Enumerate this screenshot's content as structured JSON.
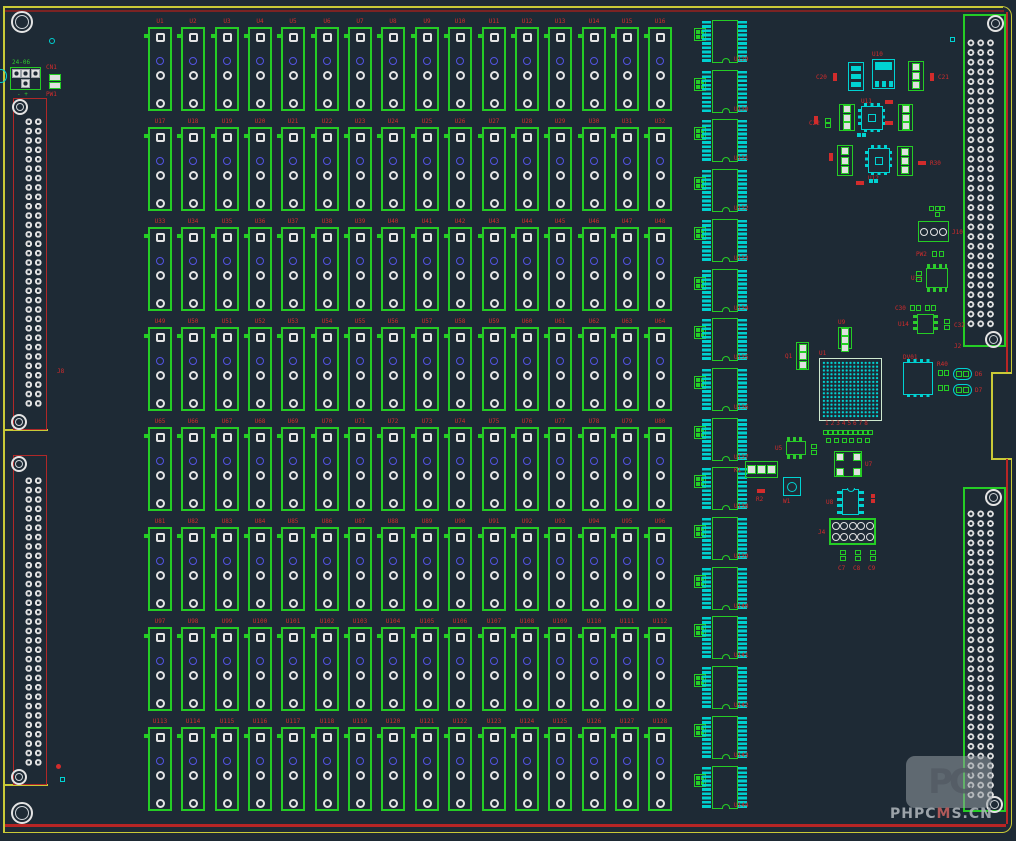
{
  "app": {
    "view": "pcb-layout-canvas"
  },
  "colors": {
    "background": "#1e2a35",
    "silkscreen_green": "#25cd25",
    "pad_cyan": "#00d2d2",
    "label_red": "#d22c2c",
    "pad_white": "#e4e4e4",
    "pad_blue": "#5353e2",
    "board_edge_yellow": "#c9c937",
    "border_maroon": "#7b2323",
    "border_red": "#b82525"
  },
  "relay_grid": {
    "rows": 8,
    "cols": 16,
    "labels": [
      "U1",
      "U2",
      "U3",
      "U4",
      "U5",
      "U6",
      "U7",
      "U8",
      "U9",
      "U10",
      "U11",
      "U12",
      "U13",
      "U14",
      "U15",
      "U16",
      "U17",
      "U18",
      "U19",
      "U20",
      "U21",
      "U22",
      "U23",
      "U24",
      "U25",
      "U26",
      "U27",
      "U28",
      "U29",
      "U30",
      "U31",
      "U32",
      "U33",
      "U34",
      "U35",
      "U36",
      "U37",
      "U38",
      "U39",
      "U40",
      "U41",
      "U42",
      "U43",
      "U44",
      "U45",
      "U46",
      "U47",
      "U48",
      "U49",
      "U50",
      "U51",
      "U52",
      "U53",
      "U54",
      "U55",
      "U56",
      "U57",
      "U58",
      "U59",
      "U60",
      "U61",
      "U62",
      "U63",
      "U64",
      "U65",
      "U66",
      "U67",
      "U68",
      "U69",
      "U70",
      "U71",
      "U72",
      "U73",
      "U74",
      "U75",
      "U76",
      "U77",
      "U78",
      "U79",
      "U80",
      "U81",
      "U82",
      "U83",
      "U84",
      "U85",
      "U86",
      "U87",
      "U88",
      "U89",
      "U90",
      "U91",
      "U92",
      "U93",
      "U94",
      "U95",
      "U96",
      "U97",
      "U98",
      "U99",
      "U100",
      "U101",
      "U102",
      "U103",
      "U104",
      "U105",
      "U106",
      "U107",
      "U108",
      "U109",
      "U110",
      "U111",
      "U112",
      "U113",
      "U114",
      "U115",
      "U116",
      "U117",
      "U118",
      "U119",
      "U120",
      "U121",
      "U122",
      "U123",
      "U124",
      "U125",
      "U126",
      "U127",
      "U128"
    ]
  },
  "ic_column": {
    "count": 16,
    "labels": [
      "U129",
      "U130",
      "U131",
      "U132",
      "U133",
      "U134",
      "U135",
      "U136",
      "U137",
      "U138",
      "U139",
      "U140",
      "U141",
      "U142",
      "U143",
      "U144"
    ]
  },
  "connectors": {
    "left_upper": {
      "pad_rows": 31,
      "pad_cols": 2
    },
    "left_lower": {
      "pad_rows": 31,
      "pad_cols": 2
    },
    "right_upper": {
      "pad_rows": 30,
      "pad_cols": 3
    },
    "right_lower": {
      "pad_rows": 30,
      "pad_cols": 3
    }
  },
  "top_left": {
    "power_label_top": "24-06",
    "power_label_polarity": "- +"
  },
  "misc_labels": [
    {
      "text": "CN1",
      "x": 46,
      "y": 64
    },
    {
      "text": "PW1",
      "x": 46,
      "y": 91
    },
    {
      "text": "J8",
      "x": 57,
      "y": 368
    },
    {
      "text": "J2",
      "x": 954,
      "y": 343
    }
  ],
  "small_parts": [
    {
      "type": "sot-cyan",
      "x": 848,
      "y": 62,
      "w": 16,
      "h": 29
    },
    {
      "type": "reg-cyan",
      "x": 872,
      "y": 59,
      "w": 23,
      "h": 30,
      "label": "U10",
      "lp": "t"
    },
    {
      "type": "v3-green",
      "x": 908,
      "y": 61,
      "w": 16,
      "h": 30
    },
    {
      "type": "r2-red-v",
      "x": 831,
      "y": 72,
      "w": 7,
      "h": 10,
      "label": "C20",
      "lp": "l"
    },
    {
      "type": "r2-red-v",
      "x": 928,
      "y": 72,
      "w": 7,
      "h": 10,
      "label": "C21",
      "lp": "r"
    },
    {
      "type": "r2-red-v",
      "x": 812,
      "y": 115,
      "w": 7,
      "h": 10
    },
    {
      "type": "g2-v",
      "x": 824,
      "y": 118,
      "w": 7,
      "h": 10,
      "label": "C22",
      "lp": "l"
    },
    {
      "type": "v3-green",
      "x": 839,
      "y": 104,
      "w": 16,
      "h": 27
    },
    {
      "type": "qfn-cyan",
      "x": 861,
      "y": 106,
      "w": 22,
      "h": 24,
      "label": "U11",
      "lp": "t"
    },
    {
      "type": "v3-green",
      "x": 898,
      "y": 104,
      "w": 15,
      "h": 27
    },
    {
      "type": "r2-red-h",
      "x": 884,
      "y": 99,
      "w": 10,
      "h": 6
    },
    {
      "type": "r2-red-h",
      "x": 884,
      "y": 120,
      "w": 10,
      "h": 6
    },
    {
      "type": "c2-cyan-h",
      "x": 857,
      "y": 132,
      "w": 9,
      "h": 5
    },
    {
      "type": "v3-green",
      "x": 837,
      "y": 145,
      "w": 16,
      "h": 31
    },
    {
      "type": "qfn-cyan",
      "x": 868,
      "y": 148,
      "w": 22,
      "h": 25,
      "label": "U12",
      "lp": "b"
    },
    {
      "type": "v3-green",
      "x": 897,
      "y": 146,
      "w": 16,
      "h": 30
    },
    {
      "type": "r2-red-v",
      "x": 827,
      "y": 152,
      "w": 7,
      "h": 10
    },
    {
      "type": "r2-red-h",
      "x": 855,
      "y": 180,
      "w": 10,
      "h": 6
    },
    {
      "type": "c2-cyan-h",
      "x": 869,
      "y": 178,
      "w": 9,
      "h": 5
    },
    {
      "type": "r2-red-h",
      "x": 917,
      "y": 160,
      "w": 10,
      "h": 6,
      "label": "R30",
      "lp": "r"
    },
    {
      "type": "g4-2x2",
      "x": 928,
      "y": 205,
      "w": 18,
      "h": 12
    },
    {
      "type": "tblock3",
      "x": 918,
      "y": 221,
      "w": 31,
      "h": 21,
      "label": "J10",
      "lp": "r"
    },
    {
      "type": "g2-h",
      "x": 931,
      "y": 250,
      "w": 14,
      "h": 8,
      "label": "PW2",
      "lp": "l"
    },
    {
      "type": "soic-tb",
      "x": 926,
      "y": 264,
      "w": 22,
      "h": 28,
      "label": "U13",
      "lp": "l"
    },
    {
      "type": "g2-v",
      "x": 915,
      "y": 270,
      "w": 8,
      "h": 13
    },
    {
      "type": "g2-h",
      "x": 910,
      "y": 305,
      "w": 11,
      "h": 6,
      "label": "C30",
      "lp": "l"
    },
    {
      "type": "g2-h",
      "x": 925,
      "y": 305,
      "w": 11,
      "h": 6
    },
    {
      "type": "soic-lr",
      "x": 913,
      "y": 314,
      "w": 25,
      "h": 20,
      "label": "U14",
      "lp": "l"
    },
    {
      "type": "g2-v",
      "x": 943,
      "y": 317,
      "w": 8,
      "h": 15,
      "label": "C32",
      "lp": "r"
    },
    {
      "type": "qfp-cyan",
      "x": 903,
      "y": 362,
      "w": 30,
      "h": 33,
      "label": "DV01",
      "lp": "t"
    },
    {
      "type": "g2-h",
      "x": 937,
      "y": 369,
      "w": 13,
      "h": 8,
      "label": "R40",
      "lp": "t"
    },
    {
      "type": "oval-cyan",
      "x": 953,
      "y": 368,
      "w": 19,
      "h": 12,
      "label": "D6",
      "lp": "r"
    },
    {
      "type": "g2-h",
      "x": 937,
      "y": 384,
      "w": 13,
      "h": 8
    },
    {
      "type": "oval-cyan",
      "x": 953,
      "y": 384,
      "w": 19,
      "h": 12,
      "label": "D7",
      "lp": "r"
    },
    {
      "type": "v3-green",
      "x": 796,
      "y": 342,
      "w": 13,
      "h": 28,
      "label": "Q1",
      "lp": "l"
    },
    {
      "type": "v3-green",
      "x": 838,
      "y": 327,
      "w": 14,
      "h": 22,
      "label": "U9",
      "lp": "t"
    },
    {
      "type": "bga",
      "x": 819,
      "y": 358,
      "w": 63,
      "h": 63,
      "label": "U1",
      "lp": "t"
    },
    {
      "type": "header2x8",
      "x": 823,
      "y": 428,
      "w": 50,
      "h": 17,
      "label": "12345678",
      "lp": "t"
    },
    {
      "type": "soic-tb",
      "x": 786,
      "y": 437,
      "w": 20,
      "h": 22,
      "label": "U5",
      "lp": "l"
    },
    {
      "type": "g2-v",
      "x": 810,
      "y": 443,
      "w": 8,
      "h": 13
    },
    {
      "type": "v3h-green",
      "x": 745,
      "y": 461,
      "w": 33,
      "h": 17,
      "label": "K1",
      "lp": "l"
    },
    {
      "type": "trimmer-cyan",
      "x": 783,
      "y": 477,
      "w": 18,
      "h": 19,
      "label": "W1",
      "lp": "b"
    },
    {
      "type": "r2-red-h",
      "x": 756,
      "y": 488,
      "w": 10,
      "h": 6,
      "label": "R2",
      "lp": "b"
    },
    {
      "type": "qfn-green",
      "x": 834,
      "y": 451,
      "w": 28,
      "h": 26,
      "label": "U7",
      "lp": "r"
    },
    {
      "type": "dip8-cyan",
      "x": 837,
      "y": 489,
      "w": 27,
      "h": 26,
      "label": "U8",
      "lp": "l"
    },
    {
      "type": "r2-red-v",
      "x": 869,
      "y": 493,
      "w": 7,
      "h": 11
    },
    {
      "type": "header2x5r",
      "x": 829,
      "y": 518,
      "w": 47,
      "h": 27,
      "label": "J4",
      "lp": "l"
    },
    {
      "type": "g2-v",
      "x": 838,
      "y": 548,
      "w": 10,
      "h": 15,
      "label": "C7",
      "lp": "b"
    },
    {
      "type": "g2-v",
      "x": 853,
      "y": 548,
      "w": 10,
      "h": 15,
      "label": "C8",
      "lp": "b"
    },
    {
      "type": "g2-v",
      "x": 868,
      "y": 548,
      "w": 10,
      "h": 15,
      "label": "C9",
      "lp": "b"
    },
    {
      "type": "pwr4",
      "x": 10,
      "y": 67,
      "w": 31,
      "h": 23
    },
    {
      "type": "cn2",
      "x": 48,
      "y": 72,
      "w": 14,
      "h": 19
    },
    {
      "type": "dot-cyan",
      "x": 49,
      "y": 38,
      "w": 6,
      "h": 6
    },
    {
      "type": "sq-cyan",
      "x": 950,
      "y": 37,
      "w": 5,
      "h": 5
    },
    {
      "type": "sq-cyan",
      "x": 60,
      "y": 777,
      "w": 5,
      "h": 5
    },
    {
      "type": "dot-red",
      "x": 56,
      "y": 764,
      "w": 5,
      "h": 5
    },
    {
      "type": "notch-cyan",
      "x": -5,
      "y": 69,
      "w": 12,
      "h": 14
    }
  ],
  "watermark": {
    "logo_text": "PC",
    "text_pre": "PHPC",
    "text_mid": "M",
    "text_post": "S.CN"
  }
}
